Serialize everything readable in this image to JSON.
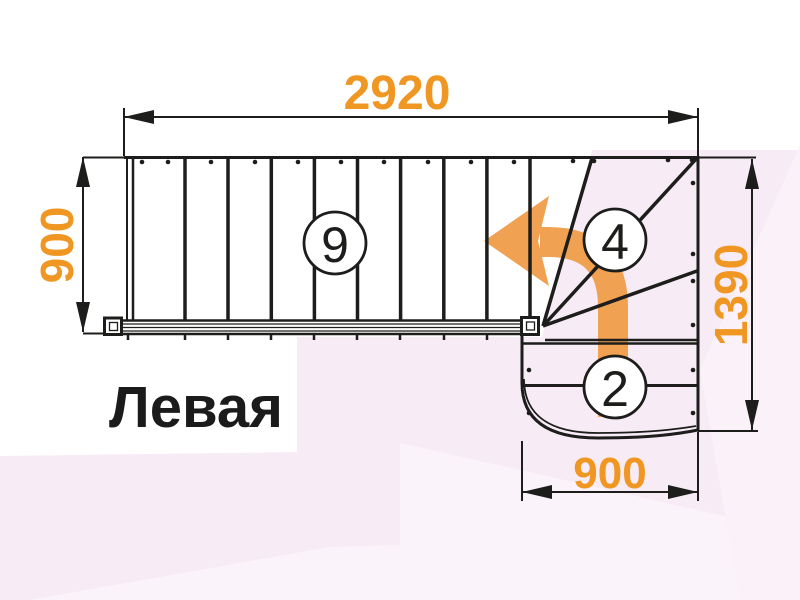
{
  "colors": {
    "dimension_text": "#EF9722",
    "direction_arrow": "#F0A152",
    "drawing_line": "#1D1D1B",
    "title_text": "#1B1B1B",
    "background": "#FFFFFF",
    "background_tint": "#F7ECF5"
  },
  "drawing": {
    "title": "Левая",
    "dimensions": {
      "total_length": "2920",
      "flight_width": "900",
      "total_width": "1390",
      "lower_flight_width": "900"
    },
    "step_counts": {
      "straight_flight": "9",
      "winder": "4",
      "lower_flight": "2"
    }
  }
}
